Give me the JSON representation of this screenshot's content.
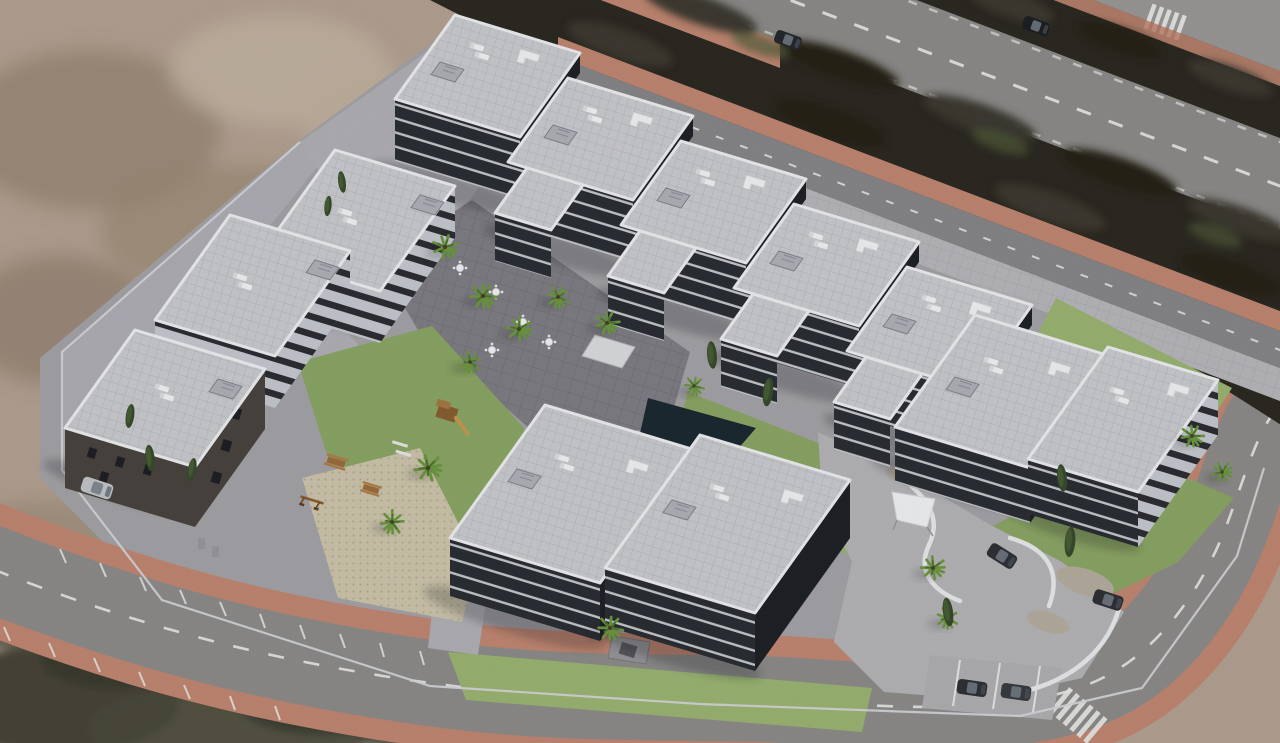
{
  "scene": {
    "type": "aerial-3d-architectural-render",
    "subject": "modern white apartment residential complex on arid scrubland plot",
    "view": "high-angle oblique aerial",
    "inventory": {
      "apartment_buildings": 6,
      "typical_floors": "4-5 with dark recessed balcony bands and white slab edges",
      "rooftop_items": [
        "sun loungers",
        "corner sofas",
        "stair bulkheads",
        "glass parapets"
      ],
      "amenities": [
        "courtyard plaza with cafe tables",
        "lawns",
        "children playground",
        "picnic tables",
        "white shade sail",
        "curved driveway",
        "gravel beds",
        "resident parking"
      ],
      "trees": {
        "palms": 14,
        "cypresses": 10
      },
      "cars_visible": 7,
      "roads": [
        "dual carriageway with dark planted median (top right)",
        "local access street with terracotta sidewalks",
        "south road with angled parking bays and zebra crossing"
      ],
      "terrain": "sandy dirt with dark scrub at bottom left"
    }
  },
  "palette": {
    "sand": "#b5a393",
    "sand_dark": "#93806d",
    "sand_light": "#c8b8a7",
    "scrub": "#4a4a3b",
    "scrub2": "#3a3b30",
    "parcel": "#a5a4a8",
    "veg": "#2d2a23",
    "veg2": "#3e3b30",
    "veg_green": "#55603c",
    "road": "#8e8d8b",
    "road_far": "#9b9a98",
    "red_sw": "#c28873",
    "line": "#ececea",
    "roof": "#cccdd1",
    "parapet": "#eef0f3",
    "facade_dark": "#2b2f35",
    "slab": "#d5d7db",
    "facade_light": "#c7cad0",
    "window": "#1e2126",
    "brown": "#4a4540",
    "plaza": "#817f86",
    "path": "#b3b2b8",
    "sidewalk": "#b9b9bd",
    "lawn": "#8ca766",
    "lawn2": "#9cb674",
    "mosaic": "#cec6ac",
    "palm": "#6d9940",
    "palm_dark": "#4e782f",
    "cypress": "#394b2d",
    "white_wall": "#e9ebec",
    "car_dark": "#2f3237",
    "car_silver": "#c4c7ca",
    "pool": "#1d2a32",
    "gravel": "#b6aea1",
    "concrete": "#b7b6b9",
    "wood": "#9c6e3e"
  }
}
